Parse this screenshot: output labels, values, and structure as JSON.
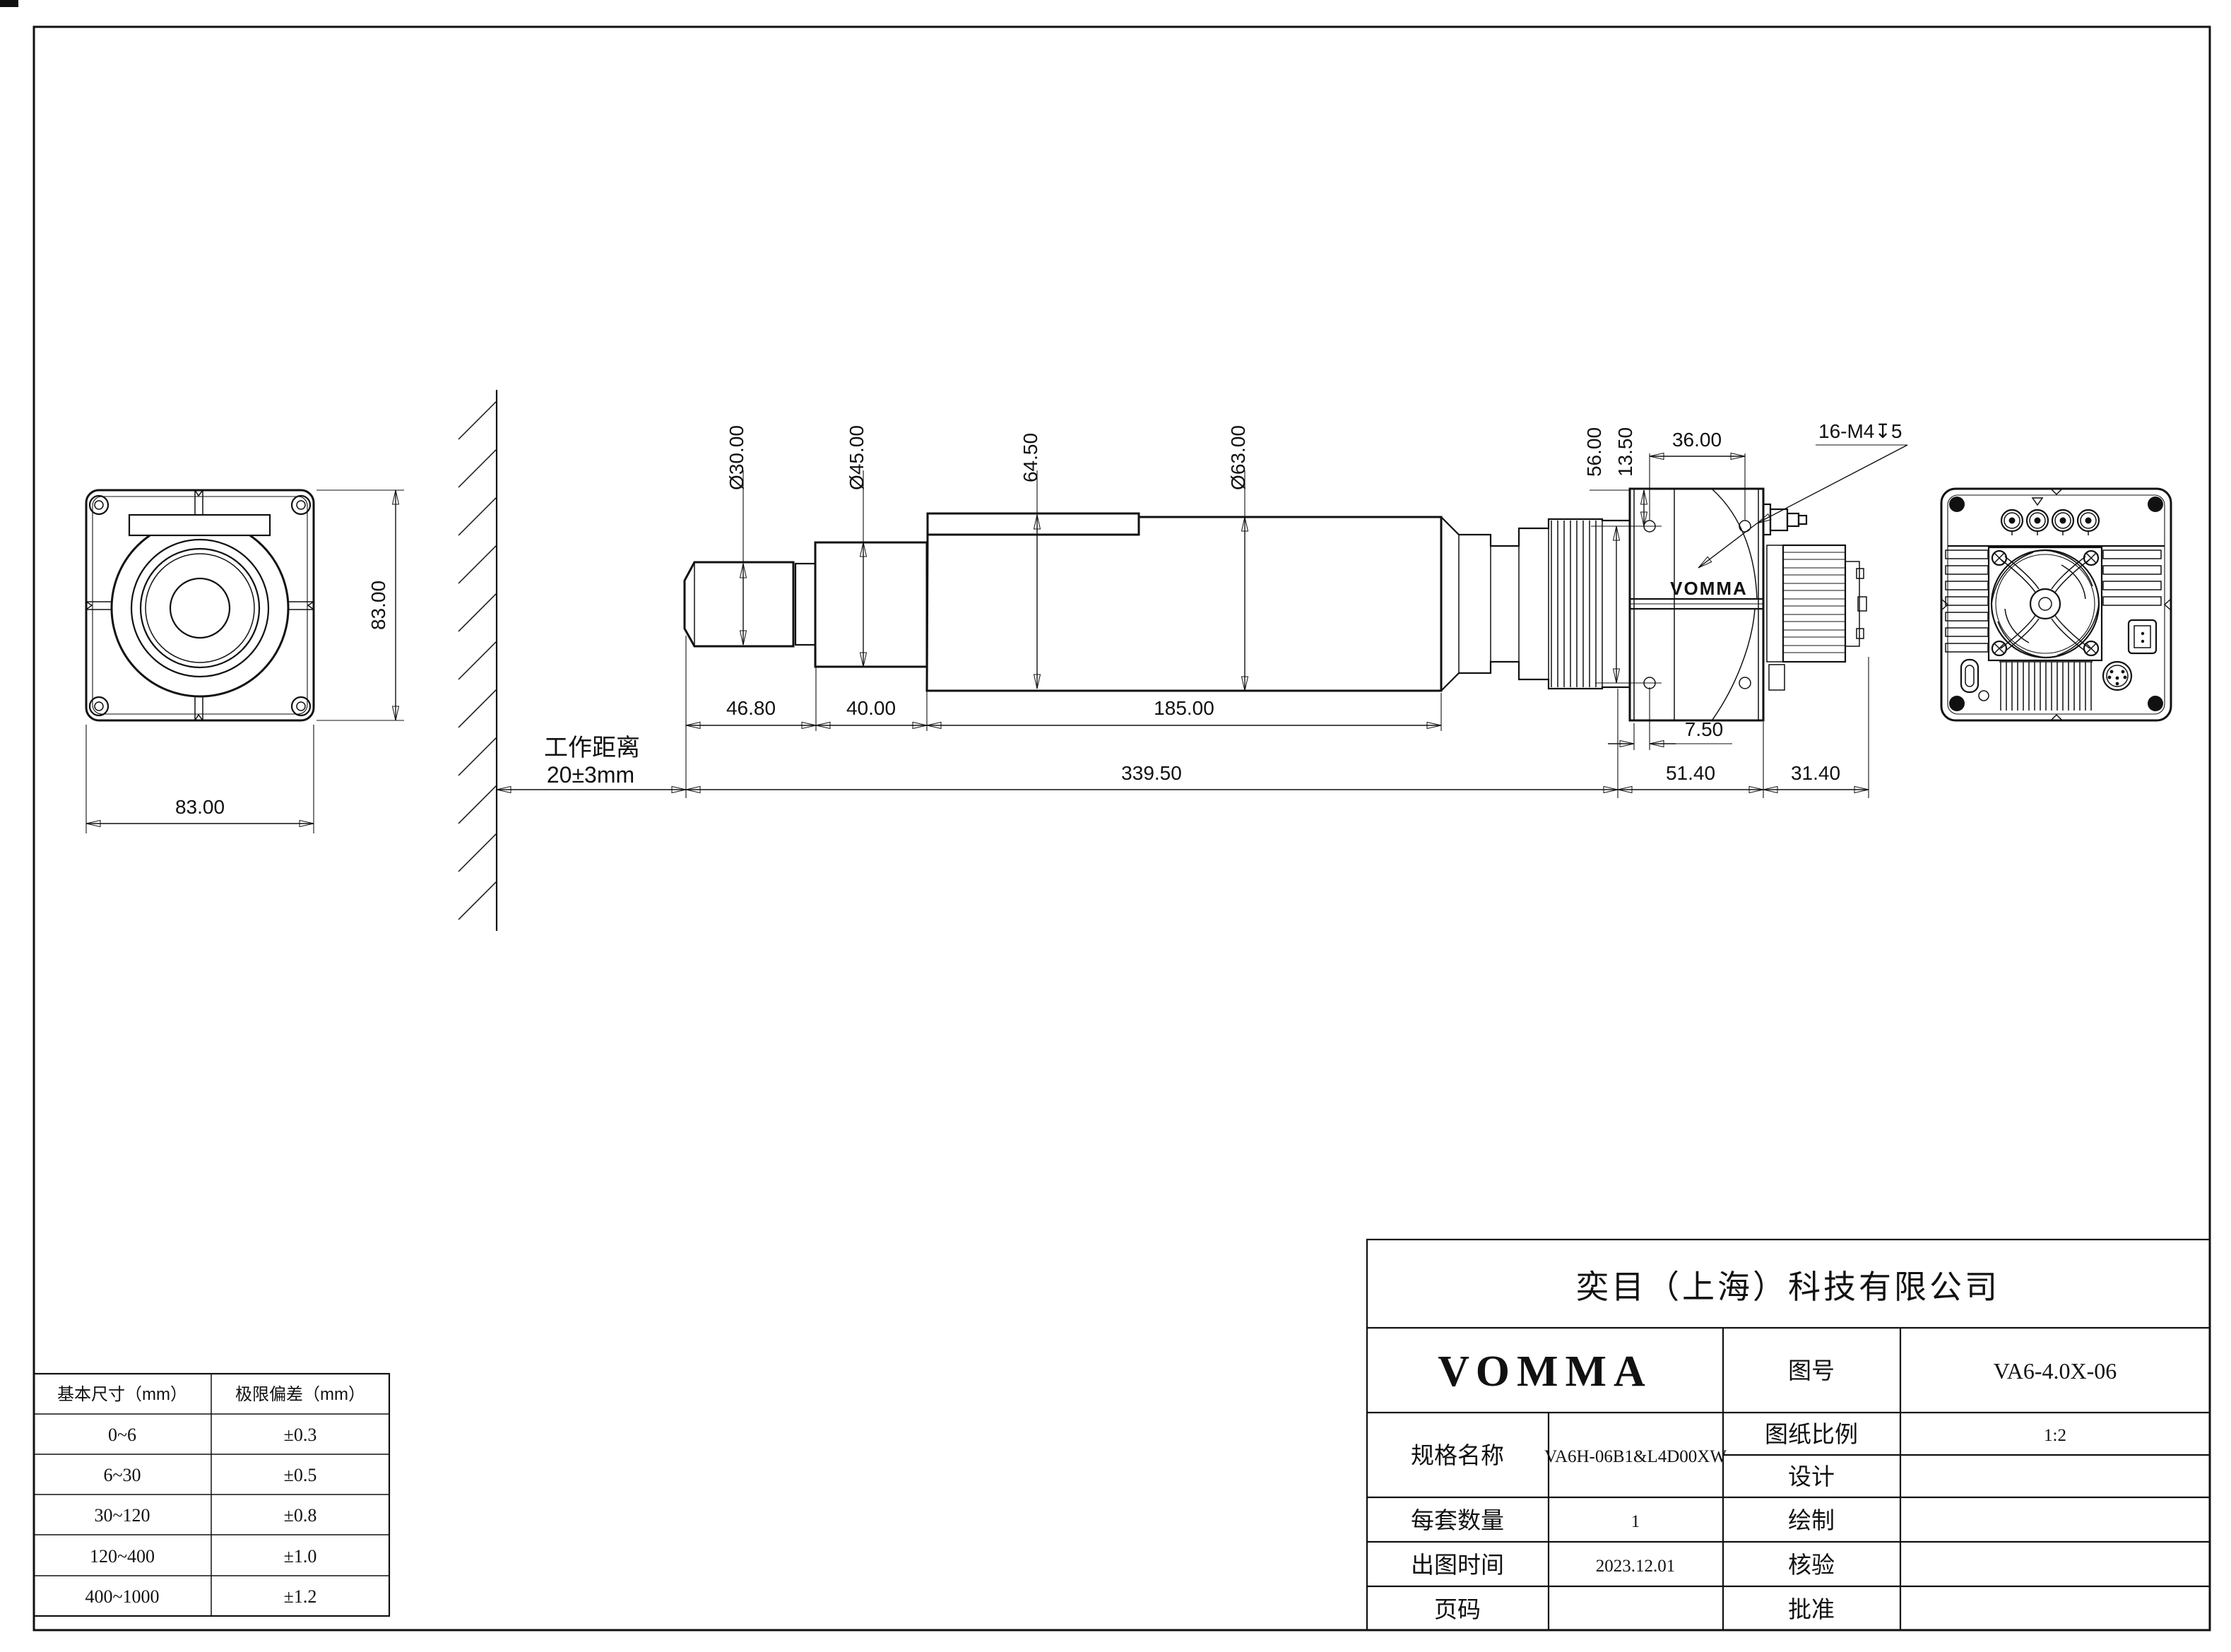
{
  "front": {
    "dim_width": "83.00",
    "dim_height": "83.00"
  },
  "side": {
    "work_distance_label": "工作距离",
    "work_distance_value": "20±3mm",
    "dia_tip": "Ø30.00",
    "dia_mid": "Ø45.00",
    "height_rail": "64.50",
    "dia_body": "Ø63.00",
    "len_tip": "46.80",
    "len_mid": "40.00",
    "len_body": "185.00",
    "len_total": "339.50",
    "screw_span_v": "56.00",
    "screw_top_offset": "13.50",
    "screw_span_h": "36.00",
    "thread_callout": "16-M4↧5",
    "screw_side_offset": "7.50",
    "head_depth": "51.40",
    "heatsink_depth": "31.40",
    "head_logo": "VOMMA"
  },
  "tolerance_table": {
    "col_basic": "基本尺寸（mm）",
    "col_limit": "极限偏差（mm）",
    "rows": [
      [
        "0~6",
        "±0.3"
      ],
      [
        "6~30",
        "±0.5"
      ],
      [
        "30~120",
        "±0.8"
      ],
      [
        "120~400",
        "±1.0"
      ],
      [
        "400~1000",
        "±1.2"
      ]
    ]
  },
  "title_block": {
    "company": "奕目（上海）科技有限公司",
    "brand": "VOMMA",
    "drawing_no_label": "图号",
    "drawing_no": "VA6-4.0X-06",
    "spec_label": "规格名称",
    "spec_value": "VA6H-06B1&L4D00XW",
    "scale_label": "图纸比例",
    "scale_value": "1:2",
    "design_label": "设计",
    "qty_label": "每套数量",
    "qty_value": "1",
    "draft_label": "绘制",
    "date_label": "出图时间",
    "date_value": "2023.12.01",
    "check_label": "核验",
    "page_label": "页码",
    "approve_label": "批准"
  }
}
